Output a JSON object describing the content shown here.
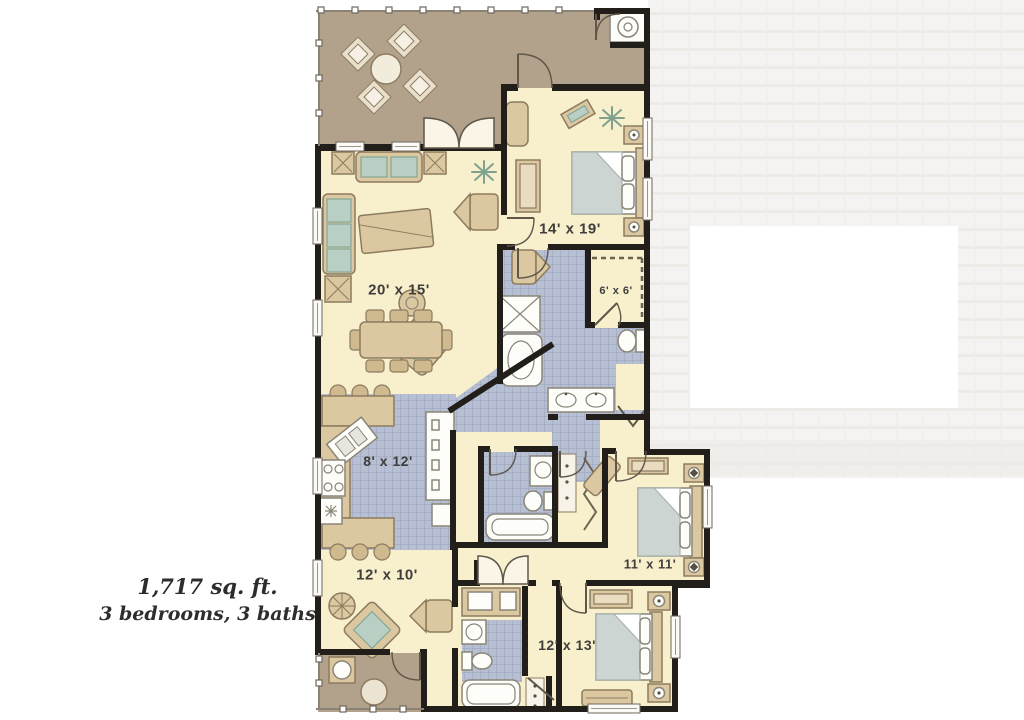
{
  "caption": {
    "line1": "1,717 sq. ft.",
    "line2": "3 bedrooms, 3 baths"
  },
  "rooms": {
    "living": {
      "label": "20' x 15'"
    },
    "master_bedroom": {
      "label": "14' x 19'"
    },
    "walk_in_closet": {
      "label": "6' x 6'"
    },
    "kitchen": {
      "label": "8' x 12'"
    },
    "den": {
      "label": "12' x 10'"
    },
    "bedroom_2": {
      "label": "11' x 11'"
    },
    "bedroom_3": {
      "label": "12' x 13'"
    }
  },
  "colors": {
    "background": "#ffffff",
    "backdrop_texture": "#f3f1ee",
    "deck": "#b2a28b",
    "floor": "#f8f0cd",
    "tile": "#b7c0d2",
    "tile_line": "#97a1b9",
    "wall": "#221f1b",
    "furniture": "#dbc7a0",
    "furniture_line": "#8d7b5f",
    "cushion": "#b9cfc3",
    "blanket": "#ccd5d1",
    "fixture": "#fdfdfa",
    "fixture_line": "#8a8578",
    "label_ink": "#3f3e3c",
    "caption_ink": "#2f2d2b"
  }
}
